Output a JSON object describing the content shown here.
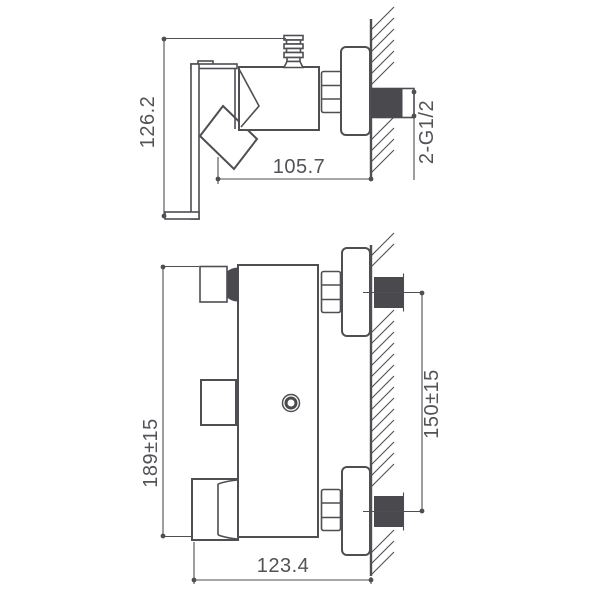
{
  "drawing": {
    "title": "shower-mixer-technical-drawing",
    "colors": {
      "background": "#ffffff",
      "line": "#4e4e53",
      "dark_fill": "#49494e",
      "text": "#525257"
    },
    "side_view": {
      "height_label": "126.2",
      "depth_label": "105.7",
      "thread_label": "2-G1/2"
    },
    "front_view": {
      "height_label": "189±15",
      "inlet_spacing_label": "150±15",
      "width_label": "123.4"
    }
  }
}
